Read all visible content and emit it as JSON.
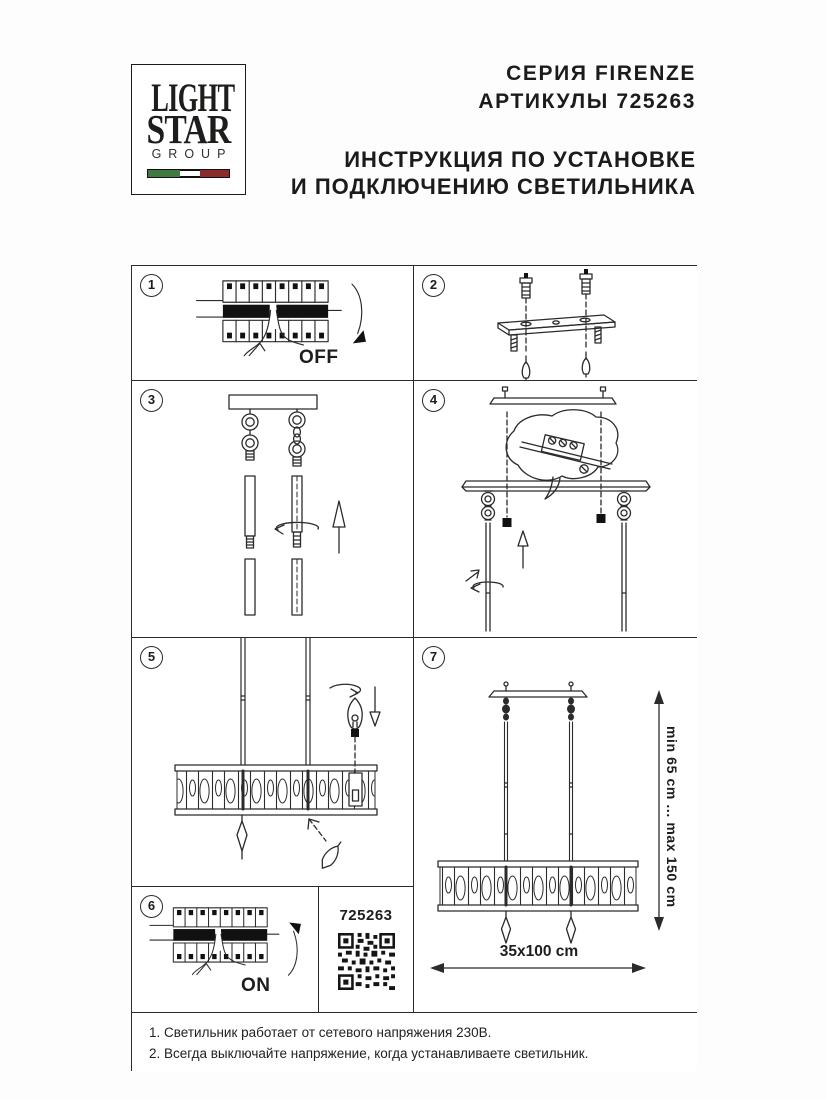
{
  "header": {
    "logo": {
      "line1": "LIGHT",
      "line2": "STAR",
      "line3": "GROUP"
    },
    "series_line": "СЕРИЯ FIRENZE",
    "article_line": "АРТИКУЛЫ 725263",
    "title_line1": "ИНСТРУКЦИЯ ПО УСТАНОВКЕ",
    "title_line2": "И ПОДКЛЮЧЕНИЮ СВЕТИЛЬНИКА"
  },
  "colors": {
    "ink": "#2b2b2b",
    "flag_green": "#3e7a41",
    "flag_red": "#8c2b2e"
  },
  "panels": {
    "p1": {
      "number": "1",
      "switch_label": "OFF"
    },
    "p2": {
      "number": "2"
    },
    "p3": {
      "number": "3"
    },
    "p4": {
      "number": "4"
    },
    "p5": {
      "number": "5"
    },
    "p6": {
      "number": "6",
      "switch_label": "ON"
    },
    "p7": {
      "number": "7",
      "height_range": "min 65 cm ... max 150 cm",
      "size_label": "35x100 cm"
    },
    "qr": {
      "article": "725263"
    }
  },
  "footer": {
    "note1": "1. Светильник работает от сетевого напряжения 230В.",
    "note2": "2. Всегда выключайте напряжение, когда устанавливаете светильник."
  }
}
